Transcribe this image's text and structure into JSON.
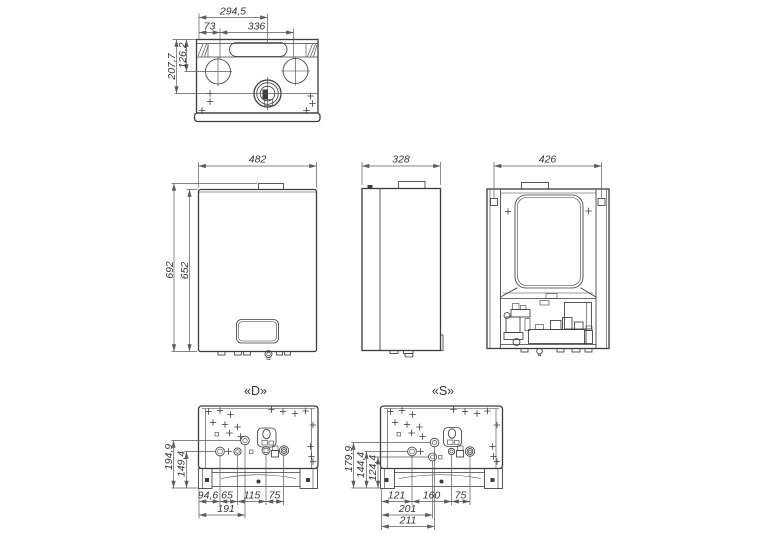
{
  "colors": {
    "line": "#3d3d3d",
    "dim": "#5b5b5b",
    "text": "#343434",
    "background": "#ffffff"
  },
  "views": {
    "top": {
      "dims": {
        "flue_offset": "294,5",
        "left_to_knockout": "73",
        "knockout_spacing": "336",
        "rear_to_flue": "207,7",
        "rear_to_knockout": "126,2"
      }
    },
    "front": {
      "dims": {
        "width": "482",
        "height_overall": "692",
        "height_casing": "652"
      }
    },
    "side": {
      "dims": {
        "depth": "328"
      }
    },
    "rear": {
      "dims": {
        "mounting_width": "426"
      }
    },
    "bottom_d": {
      "label": "«D»",
      "dims": {
        "height_gas": "194,9",
        "height_row": "149,4",
        "seg_1": "94,6",
        "seg_2": "65",
        "seg_3": "115",
        "seg_4": "75",
        "offset_gas": "191"
      }
    },
    "bottom_s": {
      "label": "«S»",
      "dims": {
        "height_top": "179,9",
        "height_mid": "144,4",
        "height_row": "124,4",
        "seg_1": "121",
        "seg_2": "160",
        "seg_3": "75",
        "offset_mid": "201",
        "offset_top": "211"
      }
    }
  }
}
